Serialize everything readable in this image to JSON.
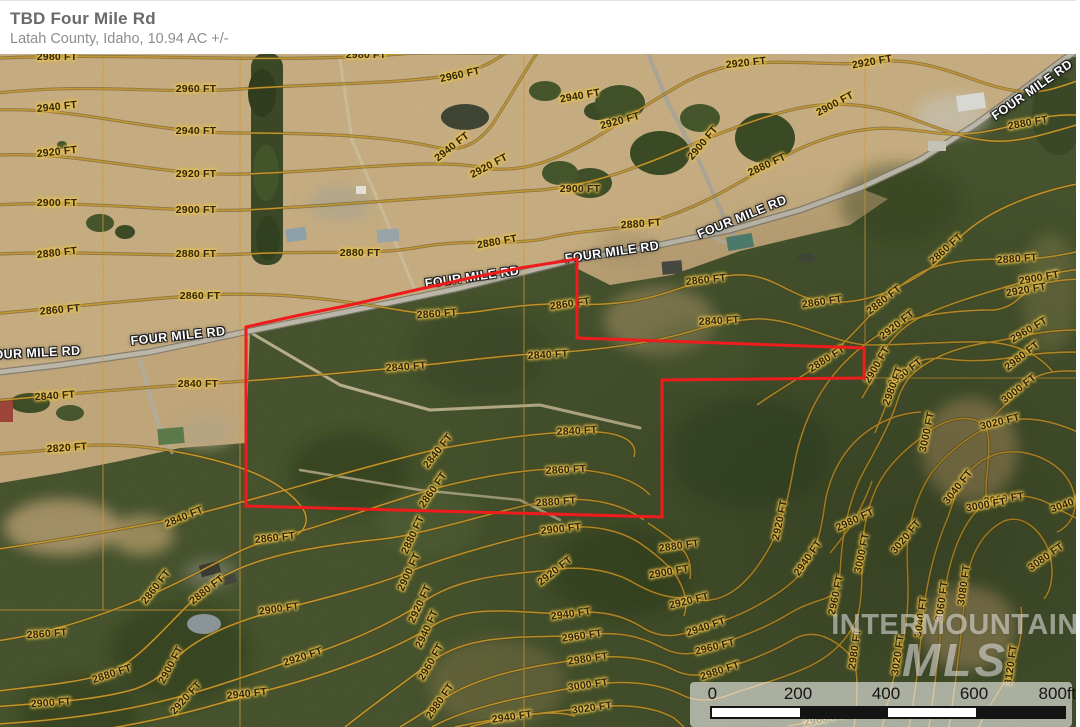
{
  "header": {
    "title": "TBD Four Mile Rd",
    "subtitle": "Latah County, Idaho, 10.94 AC +/-"
  },
  "map": {
    "road_name": "FOUR MILE RD",
    "road_labels": [
      {
        "x": 33,
        "y": 300,
        "r": -3
      },
      {
        "x": 178,
        "y": 283,
        "r": -6
      },
      {
        "x": 472,
        "y": 224,
        "r": -8
      },
      {
        "x": 612,
        "y": 199,
        "r": -8
      },
      {
        "x": 742,
        "y": 164,
        "r": -22
      },
      {
        "x": 1032,
        "y": 37,
        "r": -35
      }
    ],
    "boundary_color": "#ee1c1c",
    "contour_color": "#c69a30",
    "contour_labels": [
      {
        "t": "2980 FT",
        "x": 57,
        "y": 4,
        "r": 0
      },
      {
        "t": "2980 FT",
        "x": 366,
        "y": 2,
        "r": 0
      },
      {
        "t": "2960 FT",
        "x": 196,
        "y": 36,
        "r": 0
      },
      {
        "t": "2960 FT",
        "x": 460,
        "y": 22,
        "r": -12
      },
      {
        "t": "2940 FT",
        "x": 57,
        "y": 54,
        "r": -6
      },
      {
        "t": "2940 FT",
        "x": 196,
        "y": 78,
        "r": 0
      },
      {
        "t": "2940 FT",
        "x": 452,
        "y": 94,
        "r": -38
      },
      {
        "t": "2920 FT",
        "x": 57,
        "y": 99,
        "r": -6
      },
      {
        "t": "2920 FT",
        "x": 196,
        "y": 121,
        "r": 0
      },
      {
        "t": "2920 FT",
        "x": 489,
        "y": 113,
        "r": -28
      },
      {
        "t": "2900 FT",
        "x": 57,
        "y": 150,
        "r": 0
      },
      {
        "t": "2900 FT",
        "x": 196,
        "y": 157,
        "r": 0
      },
      {
        "t": "2880 FT",
        "x": 57,
        "y": 200,
        "r": -6
      },
      {
        "t": "2880 FT",
        "x": 196,
        "y": 201,
        "r": 0
      },
      {
        "t": "2880 FT",
        "x": 360,
        "y": 200,
        "r": 0
      },
      {
        "t": "2880 FT",
        "x": 497,
        "y": 189,
        "r": -10
      },
      {
        "t": "2860 FT",
        "x": 60,
        "y": 257,
        "r": -5
      },
      {
        "t": "2860 FT",
        "x": 200,
        "y": 243,
        "r": 0
      },
      {
        "t": "2860 FT",
        "x": 437,
        "y": 261,
        "r": -4
      },
      {
        "t": "2840 FT",
        "x": 55,
        "y": 343,
        "r": -4
      },
      {
        "t": "2840 FT",
        "x": 198,
        "y": 331,
        "r": 0
      },
      {
        "t": "2840 FT",
        "x": 406,
        "y": 314,
        "r": -4
      },
      {
        "t": "2820 FT",
        "x": 67,
        "y": 395,
        "r": -4
      },
      {
        "t": "2840 FT",
        "x": 438,
        "y": 398,
        "r": -52
      },
      {
        "t": "2860 FT",
        "x": 433,
        "y": 437,
        "r": -55
      },
      {
        "t": "2920 FT",
        "x": 746,
        "y": 10,
        "r": -6
      },
      {
        "t": "2920 FT",
        "x": 872,
        "y": 9,
        "r": -10
      },
      {
        "t": "2940 FT",
        "x": 580,
        "y": 43,
        "r": -10
      },
      {
        "t": "2920 FT",
        "x": 620,
        "y": 68,
        "r": -15
      },
      {
        "t": "2900 FT",
        "x": 835,
        "y": 51,
        "r": -28
      },
      {
        "t": "2900 FT",
        "x": 703,
        "y": 90,
        "r": -50
      },
      {
        "t": "2880 FT",
        "x": 767,
        "y": 112,
        "r": -25
      },
      {
        "t": "2880 FT",
        "x": 1028,
        "y": 70,
        "r": -10
      },
      {
        "t": "2880 FT",
        "x": 641,
        "y": 171,
        "r": -4
      },
      {
        "t": "2880 FT",
        "x": 1017,
        "y": 206,
        "r": -4
      },
      {
        "t": "2900 FT",
        "x": 580,
        "y": 136,
        "r": 0
      },
      {
        "t": "2860 FT",
        "x": 946,
        "y": 196,
        "r": -42
      },
      {
        "t": "2860 FT",
        "x": 822,
        "y": 249,
        "r": -8
      },
      {
        "t": "2860 FT",
        "x": 706,
        "y": 227,
        "r": -6
      },
      {
        "t": "2880 FT",
        "x": 884,
        "y": 247,
        "r": -38
      },
      {
        "t": "2920 FT",
        "x": 897,
        "y": 272,
        "r": -38
      },
      {
        "t": "2960 FT",
        "x": 905,
        "y": 320,
        "r": -38
      },
      {
        "t": "2980 FT",
        "x": 893,
        "y": 333,
        "r": -70
      },
      {
        "t": "2900 FT",
        "x": 1039,
        "y": 225,
        "r": -10
      },
      {
        "t": "2920 FT",
        "x": 1026,
        "y": 237,
        "r": -10
      },
      {
        "t": "2960 FT",
        "x": 1029,
        "y": 277,
        "r": -30
      },
      {
        "t": "2980 FT",
        "x": 1022,
        "y": 303,
        "r": -38
      },
      {
        "t": "3000 FT",
        "x": 1019,
        "y": 336,
        "r": -38
      },
      {
        "t": "3000 FT",
        "x": 927,
        "y": 379,
        "r": -78
      },
      {
        "t": "3020 FT",
        "x": 1000,
        "y": 369,
        "r": -14
      },
      {
        "t": "3040 FT",
        "x": 958,
        "y": 434,
        "r": -52
      },
      {
        "t": "3060 FT",
        "x": 1004,
        "y": 446,
        "r": -8
      },
      {
        "t": "3040 FT",
        "x": 1070,
        "y": 450,
        "r": -20
      },
      {
        "t": "2860 FT",
        "x": 570,
        "y": 251,
        "r": -8
      },
      {
        "t": "2840 FT",
        "x": 548,
        "y": 302,
        "r": -3
      },
      {
        "t": "2840 FT",
        "x": 719,
        "y": 268,
        "r": -3
      },
      {
        "t": "2880 FT",
        "x": 827,
        "y": 306,
        "r": -32
      },
      {
        "t": "2900 FT",
        "x": 877,
        "y": 312,
        "r": -60
      },
      {
        "t": "2840 FT",
        "x": 577,
        "y": 378,
        "r": -3
      },
      {
        "t": "2860 FT",
        "x": 566,
        "y": 417,
        "r": -3
      },
      {
        "t": "2880 FT",
        "x": 556,
        "y": 449,
        "r": -4
      },
      {
        "t": "2900 FT",
        "x": 561,
        "y": 476,
        "r": -6
      },
      {
        "t": "2880 FT",
        "x": 679,
        "y": 493,
        "r": -8
      },
      {
        "t": "2900 FT",
        "x": 669,
        "y": 519,
        "r": -10
      },
      {
        "t": "2920 FT",
        "x": 689,
        "y": 548,
        "r": -14
      },
      {
        "t": "2940 FT",
        "x": 706,
        "y": 574,
        "r": -18
      },
      {
        "t": "2960 FT",
        "x": 715,
        "y": 594,
        "r": -14
      },
      {
        "t": "2980 FT",
        "x": 720,
        "y": 618,
        "r": -18
      },
      {
        "t": "2920 FT",
        "x": 555,
        "y": 518,
        "r": -38
      },
      {
        "t": "2940 FT",
        "x": 571,
        "y": 561,
        "r": -8
      },
      {
        "t": "2960 FT",
        "x": 582,
        "y": 583,
        "r": -8
      },
      {
        "t": "2980 FT",
        "x": 588,
        "y": 606,
        "r": -8
      },
      {
        "t": "3000 FT",
        "x": 588,
        "y": 632,
        "r": -8
      },
      {
        "t": "3020 FT",
        "x": 592,
        "y": 655,
        "r": -8
      },
      {
        "t": "2920 FT",
        "x": 780,
        "y": 467,
        "r": -78
      },
      {
        "t": "2940 FT",
        "x": 808,
        "y": 505,
        "r": -55
      },
      {
        "t": "2960 FT",
        "x": 836,
        "y": 542,
        "r": -78
      },
      {
        "t": "2980 FT",
        "x": 855,
        "y": 596,
        "r": -82
      },
      {
        "t": "2980 FT",
        "x": 855,
        "y": 467,
        "r": -25
      },
      {
        "t": "3000 FT",
        "x": 862,
        "y": 500,
        "r": -78
      },
      {
        "t": "3020 FT",
        "x": 906,
        "y": 484,
        "r": -50
      },
      {
        "t": "3040 FT",
        "x": 921,
        "y": 564,
        "r": -82
      },
      {
        "t": "3020 FT",
        "x": 898,
        "y": 602,
        "r": -82
      },
      {
        "t": "3060 FT",
        "x": 942,
        "y": 548,
        "r": -82
      },
      {
        "t": "3080 FT",
        "x": 964,
        "y": 532,
        "r": -82
      },
      {
        "t": "3000 FT",
        "x": 986,
        "y": 452,
        "r": -10
      },
      {
        "t": "3080 FT",
        "x": 1046,
        "y": 504,
        "r": -35
      },
      {
        "t": "3120 FT",
        "x": 1011,
        "y": 612,
        "r": -82
      },
      {
        "t": "2960 FT",
        "x": 824,
        "y": 666,
        "r": -12
      },
      {
        "t": "2840 FT",
        "x": 184,
        "y": 464,
        "r": -22
      },
      {
        "t": "2860 FT",
        "x": 275,
        "y": 485,
        "r": -6
      },
      {
        "t": "2860 FT",
        "x": 156,
        "y": 534,
        "r": -52
      },
      {
        "t": "2880 FT",
        "x": 207,
        "y": 537,
        "r": -38
      },
      {
        "t": "2900 FT",
        "x": 279,
        "y": 556,
        "r": -8
      },
      {
        "t": "2860 FT",
        "x": 47,
        "y": 581,
        "r": -4
      },
      {
        "t": "2880 FT",
        "x": 112,
        "y": 621,
        "r": -18
      },
      {
        "t": "2900 FT",
        "x": 51,
        "y": 650,
        "r": -4
      },
      {
        "t": "2900 FT",
        "x": 171,
        "y": 612,
        "r": -62
      },
      {
        "t": "2920 FT",
        "x": 186,
        "y": 645,
        "r": -48
      },
      {
        "t": "2920 FT",
        "x": 303,
        "y": 604,
        "r": -18
      },
      {
        "t": "2940 FT",
        "x": 247,
        "y": 641,
        "r": -6
      },
      {
        "t": "2880 FT",
        "x": 413,
        "y": 482,
        "r": -65
      },
      {
        "t": "2900 FT",
        "x": 409,
        "y": 519,
        "r": -65
      },
      {
        "t": "2920 FT",
        "x": 420,
        "y": 551,
        "r": -65
      },
      {
        "t": "2940 FT",
        "x": 427,
        "y": 576,
        "r": -65
      },
      {
        "t": "2960 FT",
        "x": 431,
        "y": 609,
        "r": -60
      },
      {
        "t": "2980 FT",
        "x": 440,
        "y": 648,
        "r": -55
      },
      {
        "t": "2940 FT",
        "x": 512,
        "y": 664,
        "r": -8
      }
    ],
    "watermark": {
      "line1": "INTERMOUNTAIN",
      "line2": "MLS"
    },
    "scale_bar": {
      "ticks": [
        {
          "label": "0",
          "x": 0
        },
        {
          "label": "200",
          "x": 88
        },
        {
          "label": "400",
          "x": 176
        },
        {
          "label": "600",
          "x": 264
        },
        {
          "label": "800ft",
          "x": 352
        }
      ],
      "segment_colors": [
        "#ffffff",
        "#141414",
        "#ffffff",
        "#141414"
      ]
    }
  }
}
